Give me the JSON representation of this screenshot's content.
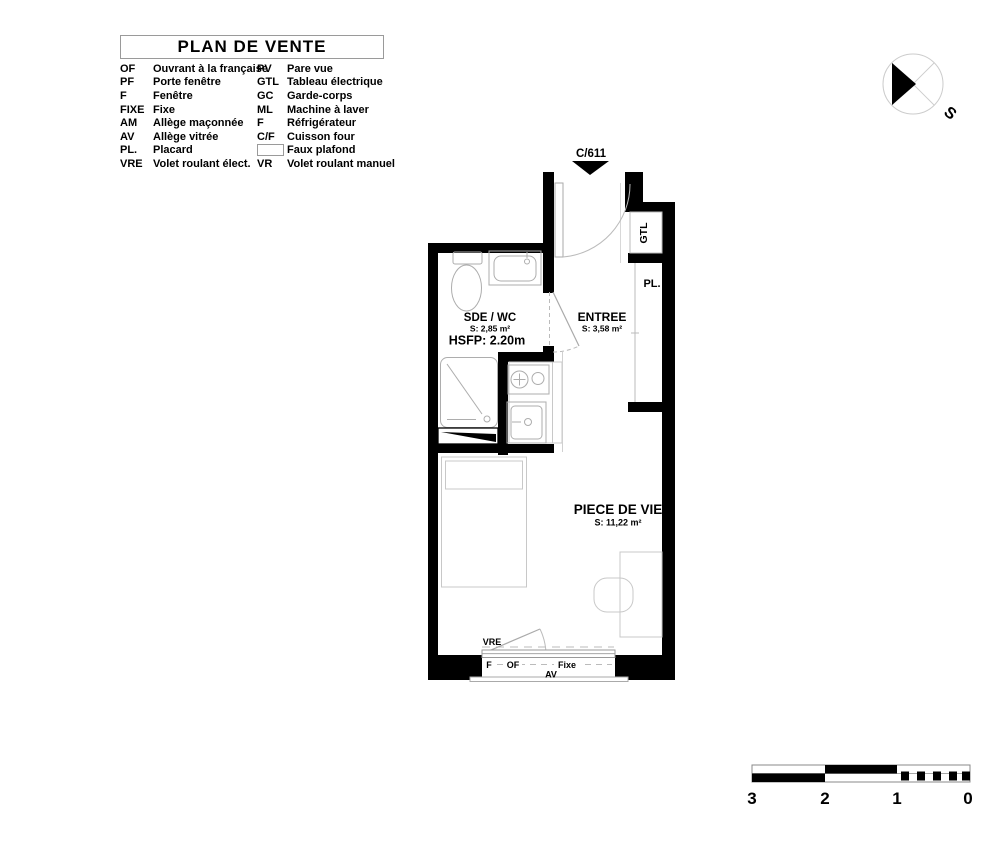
{
  "title": "PLAN DE VENTE",
  "legend": {
    "rows": [
      {
        "abbr": "OF",
        "label": "Ouvrant à la française",
        "abbr2": "PV",
        "label2": "Pare vue"
      },
      {
        "abbr": "PF",
        "label": "Porte fenêtre",
        "abbr2": "GTL",
        "label2": "Tableau électrique"
      },
      {
        "abbr": "F",
        "label": "Fenêtre",
        "abbr2": "GC",
        "label2": "Garde-corps"
      },
      {
        "abbr": "FIXE",
        "label": "Fixe",
        "abbr2": "ML",
        "label2": "Machine à laver"
      },
      {
        "abbr": "AM",
        "label": "Allège maçonnée",
        "abbr2": "F",
        "label2": "Réfrigérateur"
      },
      {
        "abbr": "AV",
        "label": "Allège vitrée",
        "abbr2": "C/F",
        "label2": "Cuisson four"
      },
      {
        "abbr": "PL.",
        "label": "Placard",
        "abbr2": "",
        "label2": "Faux plafond"
      },
      {
        "abbr": "VRE",
        "label": "Volet roulant élect.",
        "abbr2": "VR",
        "label2": "Volet roulant manuel"
      }
    ]
  },
  "compass": {
    "south_label": "S"
  },
  "plan": {
    "unit_ref": "C/611",
    "sde_name": "SDE / WC",
    "sde_area": "S: 2,85 m²",
    "sde_height": "HSFP: 2.20m",
    "entree_name": "ENTREE",
    "entree_area": "S: 3,58 m²",
    "piece_name": "PIECE DE VIE",
    "piece_area": "S: 11,22 m²",
    "gtl_label": "GTL",
    "placard_label": "PL.",
    "vre_label": "VRE",
    "window_f": "F",
    "window_of": "OF",
    "window_fixe": "Fixe",
    "window_av": "AV"
  },
  "scale_bar": {
    "labels": [
      "3",
      "2",
      "1",
      "0"
    ]
  }
}
